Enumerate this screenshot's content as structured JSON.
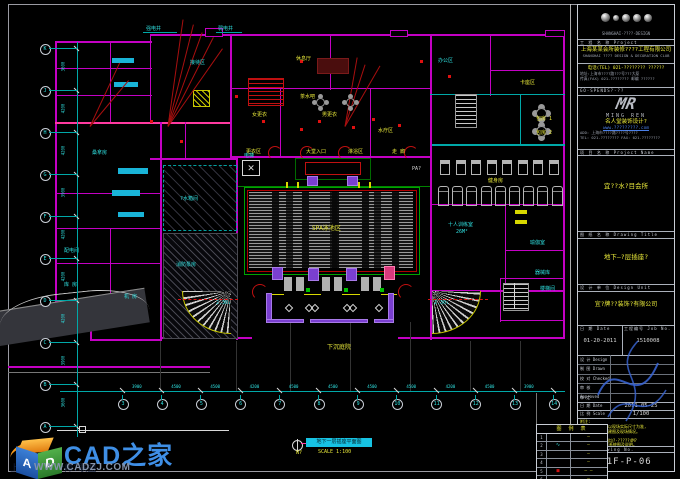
{
  "watermark": {
    "brand": "CAD之家",
    "url": "WWW.CADZJ.COM",
    "behind_text": "上海室内设计师?联盟",
    "cube_a": "A",
    "cube_d": "D"
  },
  "titleblock": {
    "logo_caption": "SHANGHAI·????·DESIGN",
    "project_label": "工 程 名 称  Project",
    "company_cn": "上海某某会所装修????工程有限公司",
    "company_en": "SHANGHAI ???? DESIGN & DECORATION CLUB",
    "contact1": "电话(TEL) 021-???????? ??????",
    "contact2": "地址:上海市????路???号???大厦",
    "contact3": "传真(FAX) 021-???????? 邮编 ??????",
    "quali": "GO-SPENDS?-??",
    "mr_logo": "MR",
    "mr_name": "MING REN",
    "mr_cn": "名人堂装饰设计?",
    "mr_site": "www.?????????.com",
    "mr_add": "ADD: 上海市????路????号????",
    "mr_tel": "TEL: 021-???????? FAX: 021-????????",
    "pname_label": "项 目 名 称  Project Name",
    "pname": "宜??水?目会所",
    "dtitle_label": "图 纸 名 称  Drawing Title",
    "dtitle": "地下—?层插座?",
    "design_label": "设 计 单 位  Design Unit",
    "design_co": "宜?牌??装饰?有限公司",
    "date_label": "日 期 Date",
    "date_val": "01-20-2011",
    "job_label": "工程编号 Job No.",
    "job_val": "1510008",
    "sig_rows": [
      {
        "label": "设 计 Design"
      },
      {
        "label": "制 图 Drawn"
      },
      {
        "label": "校 对 Checked"
      },
      {
        "label": "审 核 Approved"
      },
      {
        "label": "审 定 Ratified"
      }
    ],
    "date2_label": "日 期 Date",
    "date2_val": "2011-05-25",
    "scale_label": "比 例 Scale",
    "scale_val": "1/100",
    "notes_label": "附注:",
    "notes": [
      "本图所有尺寸均以现场实际尺寸为准,",
      "施工前须核对土建图及现场情况。",
      "?HARD??:",
      "凡AUTOCAD制图均?·?????4M?",
      "所有??配线详见系统图及说明。"
    ],
    "no_label": "图 号 Drawing No.",
    "drawing_no": "-1F-P-06"
  },
  "legend": {
    "title": "图 例 表",
    "rows": [
      {
        "no": "1",
        "sym": "",
        "val": "–"
      },
      {
        "no": "2",
        "sym": "∿",
        "val": "–"
      },
      {
        "no": "3",
        "sym": "",
        "val": "–"
      },
      {
        "no": "4",
        "sym": "",
        "val": "–"
      },
      {
        "no": "5",
        "sym": "■",
        "val": "– –"
      },
      {
        "no": "6",
        "sym": "",
        "val": "–"
      }
    ]
  },
  "plan": {
    "title_bar": {
      "text": "地下一层插座平面图",
      "scale": "SCALE 1:100",
      "north": "N?"
    },
    "gym": {
      "top_count": 8,
      "bottom_count": 9
    },
    "axis_bottom": {
      "labels": [
        "3",
        "4",
        "5",
        "6",
        "7",
        "8",
        "9",
        "10",
        "11",
        "12",
        "13",
        "14"
      ],
      "dims": [
        "3900",
        "4500",
        "4500",
        "4200",
        "4500",
        "4500",
        "4500",
        "4500",
        "4200",
        "4500",
        "3900"
      ]
    },
    "axis_left": {
      "labels": [
        "K",
        "J",
        "H",
        "G",
        "F",
        "E",
        "D",
        "C",
        "B",
        "A"
      ],
      "dims": [
        "3600",
        "4200",
        "4200",
        "3900",
        "4200",
        "4200",
        "4200",
        "3900",
        "3600"
      ]
    },
    "labels": [
      {
        "t": "SPA泳池区",
        "x": 312,
        "y": 226,
        "c": "ly",
        "s": 6
      },
      {
        "t": "下沉庭院",
        "x": 327,
        "y": 345,
        "c": "ly",
        "s": 6
      },
      {
        "t": "健身房",
        "x": 488,
        "y": 178,
        "c": "ly"
      },
      {
        "t": "包房 1",
        "x": 536,
        "y": 116,
        "c": "ly"
      },
      {
        "t": "包房 2",
        "x": 536,
        "y": 130,
        "c": "ly"
      },
      {
        "t": "大堂入口",
        "x": 306,
        "y": 149,
        "c": "ly"
      },
      {
        "t": "更衣区",
        "x": 246,
        "y": 149,
        "c": "ly"
      },
      {
        "t": "淋浴区",
        "x": 348,
        "y": 149,
        "c": "ly"
      },
      {
        "t": "走 廊",
        "x": 392,
        "y": 149,
        "c": "ly"
      },
      {
        "t": "女更衣",
        "x": 252,
        "y": 112,
        "c": "ly"
      },
      {
        "t": "男更衣",
        "x": 322,
        "y": 112,
        "c": "ly"
      },
      {
        "t": "水疗区",
        "x": 378,
        "y": 128,
        "c": "ly"
      },
      {
        "t": "茶水吧",
        "x": 300,
        "y": 94,
        "c": "ly"
      },
      {
        "t": "卡座区",
        "x": 520,
        "y": 80,
        "c": "ly"
      },
      {
        "t": "休息厅",
        "x": 296,
        "y": 56,
        "c": "ly"
      },
      {
        "t": "十人训练室",
        "x": 448,
        "y": 222,
        "c": "lc"
      },
      {
        "t": "26M²",
        "x": 456,
        "y": 229,
        "c": "lc"
      },
      {
        "t": "瑜伽室",
        "x": 530,
        "y": 240,
        "c": "lc"
      },
      {
        "t": "器械库",
        "x": 535,
        "y": 270,
        "c": "lc"
      },
      {
        "t": "楼梯间",
        "x": 540,
        "y": 286,
        "c": "lc"
      },
      {
        "t": "?水箱间",
        "x": 180,
        "y": 196,
        "c": "lc"
      },
      {
        "t": "消防泵房",
        "x": 176,
        "y": 262,
        "c": "lc"
      },
      {
        "t": "机 房",
        "x": 124,
        "y": 294,
        "c": "lc"
      },
      {
        "t": "配电间",
        "x": 64,
        "y": 248,
        "c": "lc"
      },
      {
        "t": "库 房",
        "x": 64,
        "y": 282,
        "c": "lc"
      },
      {
        "t": "桑拿房",
        "x": 92,
        "y": 150,
        "c": "lc"
      },
      {
        "t": "接待区",
        "x": 190,
        "y": 60,
        "c": "lc"
      },
      {
        "t": "办公区",
        "x": 438,
        "y": 58,
        "c": "lc"
      },
      {
        "t": "强电井",
        "x": 146,
        "y": 26,
        "c": "lc"
      },
      {
        "t": "弱电井",
        "x": 218,
        "y": 26,
        "c": "lc"
      },
      {
        "t": "2.30↓",
        "x": 216,
        "y": 300,
        "c": "lc"
      },
      {
        "t": "2.30↓",
        "x": 434,
        "y": 300,
        "c": "lc"
      },
      {
        "t": "PA?",
        "x": 412,
        "y": 166,
        "c": "lw"
      },
      {
        "t": "电梯",
        "x": 244,
        "y": 153,
        "c": "lc"
      }
    ]
  }
}
